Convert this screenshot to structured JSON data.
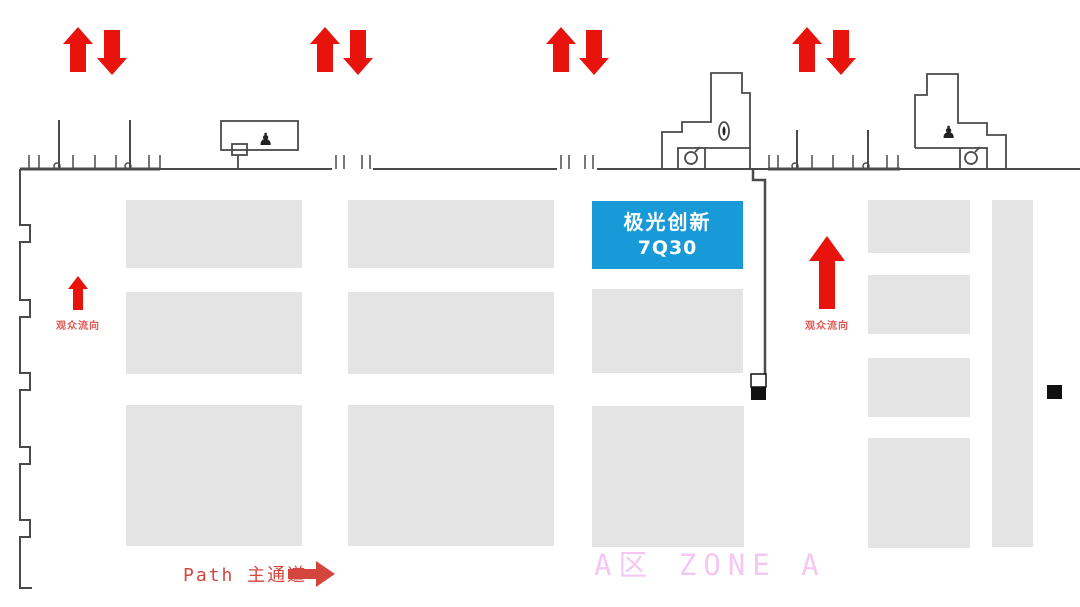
{
  "booth": {
    "name": "极光创新",
    "number": "7Q30"
  },
  "labels": {
    "flow_left": "观众流向",
    "flow_right": "观众流向",
    "path": "Path 主通道",
    "zone": "A区  ZONE A"
  },
  "icons": {
    "top_arrows": "up-down-arrow-pair-icon",
    "flow_arrows": "up-arrow-icon",
    "path_arrow": "right-arrow-icon",
    "facility": "lamp-icon",
    "hose_reel": "circle-reel-icon"
  },
  "colors": {
    "booth_blue": "#189AD8",
    "arrow_red": "#E8130C",
    "flow_label_red": "#E05A55",
    "path_label_red": "#D4453E",
    "zone_pink": "#F4C8F2",
    "block_gray": "#E5E4E4",
    "wall": "#4A4A4A",
    "pillar_black": "#111111"
  }
}
